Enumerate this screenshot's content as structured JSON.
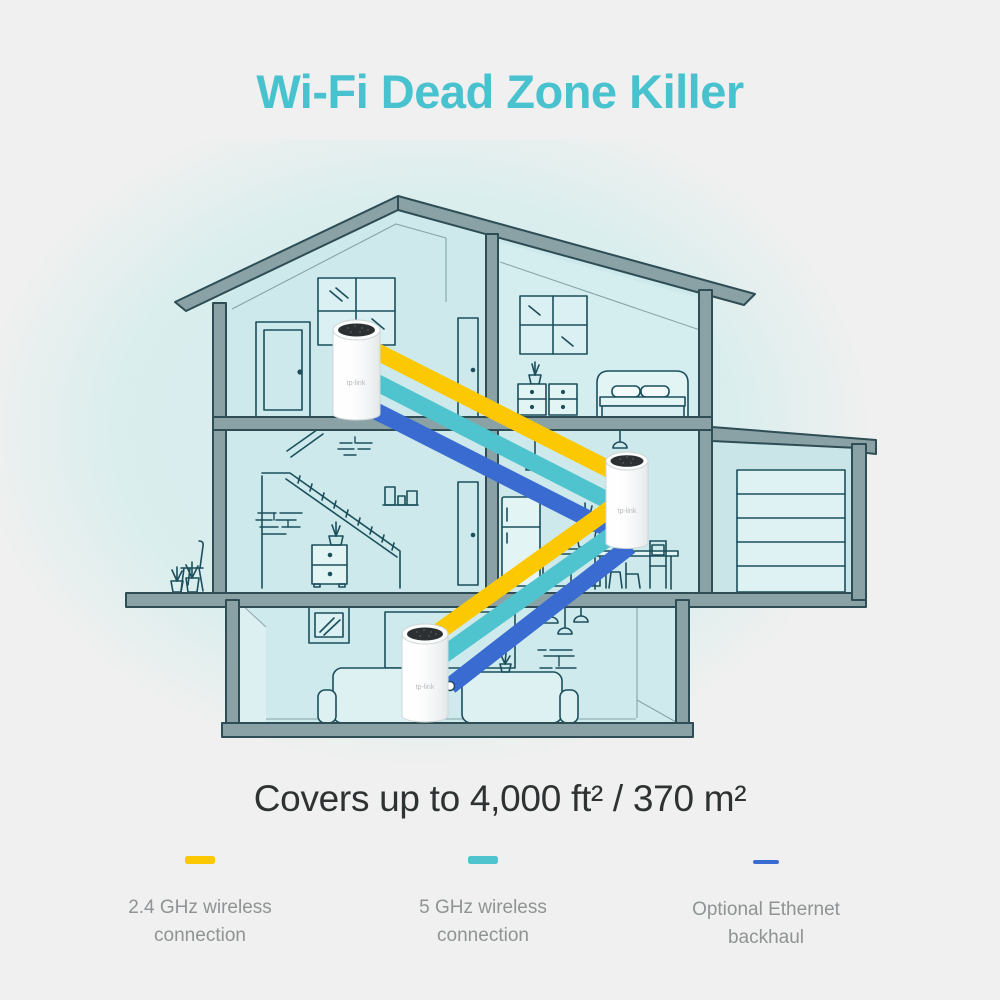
{
  "title": "Wi-Fi Dead Zone Killer",
  "coverage_text": "Covers up to 4,000 ft² / 370 m²",
  "deco_logo": "tp-link",
  "colors": {
    "title_accent": "#48c2ce",
    "wireless_24ghz": "#fcc802",
    "wireless_5ghz": "#4fc4ce",
    "ethernet_backhaul": "#3a6bd0",
    "house_structure": "#8aa2a5",
    "room_fill": "#cde9eb"
  },
  "legend": {
    "items": [
      {
        "swatch_color": "#fcc802",
        "label": "2.4 GHz wireless\nconnection"
      },
      {
        "swatch_color": "#4fc4ce",
        "label": "5 GHz wireless\nconnection"
      },
      {
        "swatch_color": "#3a6bd0",
        "label": "Optional Ethernet\nbackhaul"
      }
    ]
  }
}
